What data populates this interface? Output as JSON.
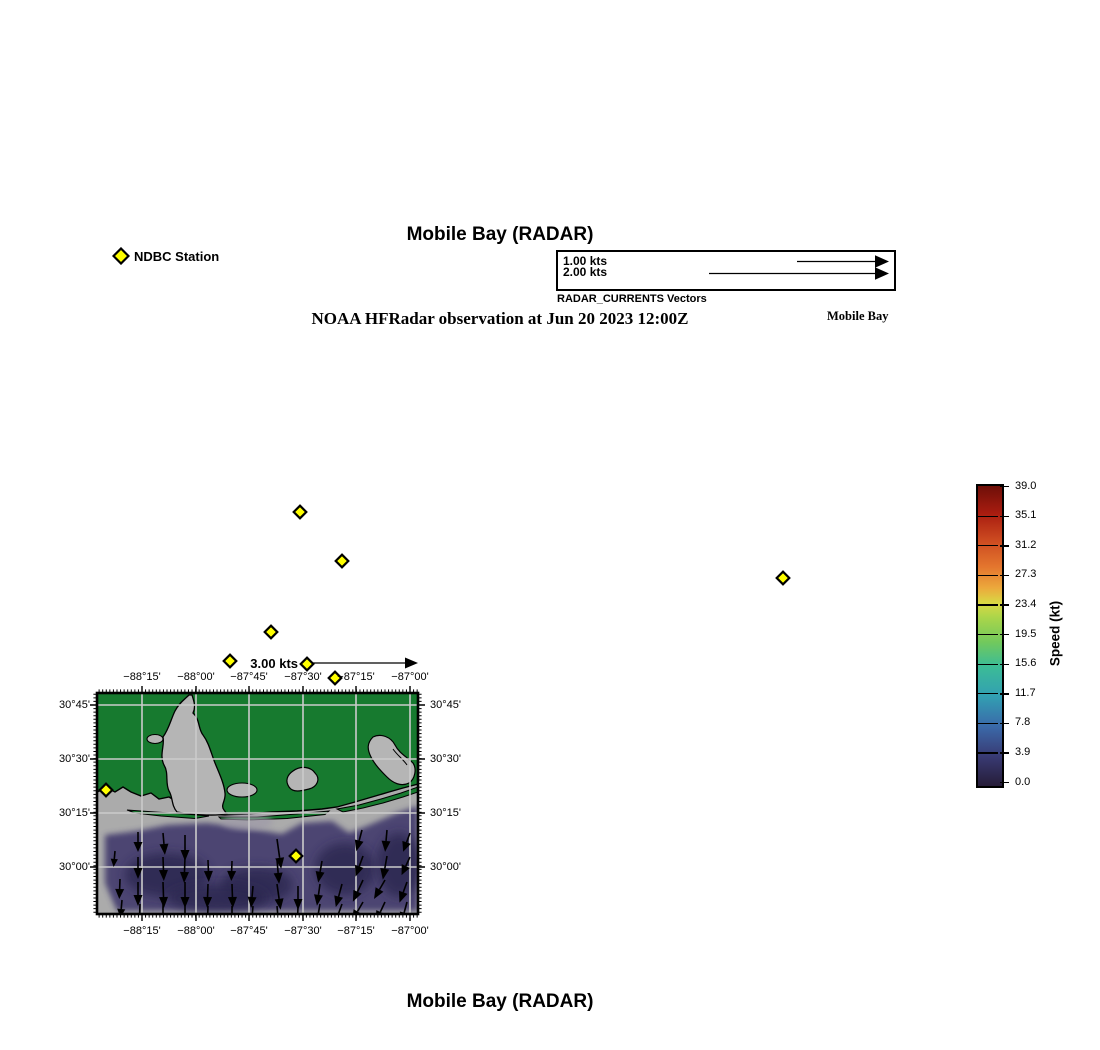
{
  "header": {
    "title": "Mobile Bay (RADAR)",
    "subtitle": "NOAA HFRadar observation at Jun 20 2023 12:00Z",
    "region_label": "Mobile Bay",
    "ndbc_legend_label": "NDBC Station"
  },
  "footer": {
    "title": "Mobile Bay (RADAR)"
  },
  "vector_legend": {
    "title": "RADAR_CURRENTS Vectors",
    "entries": [
      {
        "label": "1.00 kts",
        "tail_from": 239
      },
      {
        "label": "2.00 kts",
        "tail_from": 151
      }
    ],
    "scale_arrow_label": "3.00 kts"
  },
  "colorbar": {
    "label": "Speed (kt)",
    "ticks": [
      "39.0",
      "35.1",
      "31.2",
      "27.3",
      "23.4",
      "19.5",
      "15.6",
      "11.7",
      "7.8",
      "3.9",
      "0.0"
    ],
    "gradient": [
      {
        "pos": 0,
        "color": "#6e0f08"
      },
      {
        "pos": 9,
        "color": "#a81c10"
      },
      {
        "pos": 18,
        "color": "#cc4a20"
      },
      {
        "pos": 27,
        "color": "#e4762e"
      },
      {
        "pos": 34,
        "color": "#eca93c"
      },
      {
        "pos": 39,
        "color": "#d9d844"
      },
      {
        "pos": 44,
        "color": "#a9d54a"
      },
      {
        "pos": 52,
        "color": "#72c95c"
      },
      {
        "pos": 60,
        "color": "#3cbc96"
      },
      {
        "pos": 70,
        "color": "#32a0b2"
      },
      {
        "pos": 80,
        "color": "#3a6aaa"
      },
      {
        "pos": 90,
        "color": "#393b74"
      },
      {
        "pos": 100,
        "color": "#261c38"
      }
    ]
  },
  "map": {
    "x_ticks": [
      "−88°15'",
      "−88°00'",
      "−87°45'",
      "−87°30'",
      "−87°15'",
      "−87°00'"
    ],
    "y_ticks": [
      "30°45'",
      "30°30'",
      "30°15'",
      "30°00'"
    ],
    "x_px": [
      142,
      196,
      249,
      303,
      356,
      410
    ],
    "y_px": [
      705,
      759,
      813,
      867
    ],
    "colors": {
      "land": "#177a2f",
      "no_data_water": "#b5b5b5",
      "gulf": "#ababab",
      "current_low": "#474170",
      "current_dark": "#2c2750",
      "grid": "#cbcbcb",
      "frame": "#000000",
      "station_fill": "#ffff00"
    },
    "stations_offmap_px": [
      [
        300,
        512
      ],
      [
        342,
        561
      ],
      [
        783,
        578
      ],
      [
        271,
        632
      ],
      [
        230,
        661
      ],
      [
        307,
        664
      ],
      [
        335,
        678
      ]
    ],
    "stations_onmap_local": [
      [
        9,
        97
      ],
      [
        199,
        163
      ]
    ],
    "arrows": [
      [
        41,
        139,
        180,
        20
      ],
      [
        66,
        140,
        175,
        22
      ],
      [
        88,
        142,
        180,
        26
      ],
      [
        180,
        146,
        172,
        30
      ],
      [
        265,
        137,
        195,
        22
      ],
      [
        290,
        137,
        185,
        22
      ],
      [
        313,
        140,
        200,
        20
      ],
      [
        18,
        158,
        185,
        16
      ],
      [
        41,
        164,
        180,
        22
      ],
      [
        66,
        164,
        178,
        24
      ],
      [
        88,
        164,
        182,
        26
      ],
      [
        111,
        167,
        178,
        22
      ],
      [
        135,
        168,
        182,
        20
      ],
      [
        180,
        167,
        175,
        24
      ],
      [
        225,
        168,
        190,
        22
      ],
      [
        266,
        163,
        200,
        22
      ],
      [
        290,
        163,
        190,
        24
      ],
      [
        313,
        164,
        205,
        20
      ],
      [
        23,
        186,
        182,
        20
      ],
      [
        41,
        189,
        180,
        24
      ],
      [
        66,
        189,
        178,
        26
      ],
      [
        88,
        189,
        180,
        26
      ],
      [
        111,
        191,
        182,
        24
      ],
      [
        135,
        191,
        178,
        24
      ],
      [
        156,
        193,
        185,
        22
      ],
      [
        180,
        191,
        172,
        26
      ],
      [
        201,
        193,
        180,
        24
      ],
      [
        223,
        191,
        188,
        22
      ],
      [
        245,
        191,
        195,
        24
      ],
      [
        266,
        187,
        205,
        24
      ],
      [
        288,
        187,
        210,
        22
      ],
      [
        310,
        189,
        200,
        22
      ],
      [
        25,
        207,
        185,
        18
      ],
      [
        43,
        211,
        182,
        22
      ],
      [
        66,
        211,
        180,
        24
      ],
      [
        88,
        211,
        180,
        24
      ],
      [
        111,
        213,
        182,
        22
      ],
      [
        135,
        213,
        180,
        22
      ],
      [
        156,
        213,
        185,
        20
      ],
      [
        180,
        213,
        175,
        22
      ],
      [
        201,
        213,
        182,
        22
      ],
      [
        223,
        211,
        190,
        22
      ],
      [
        245,
        211,
        200,
        22
      ],
      [
        266,
        209,
        210,
        22
      ],
      [
        288,
        209,
        205,
        22
      ],
      [
        310,
        209,
        195,
        22
      ]
    ]
  }
}
